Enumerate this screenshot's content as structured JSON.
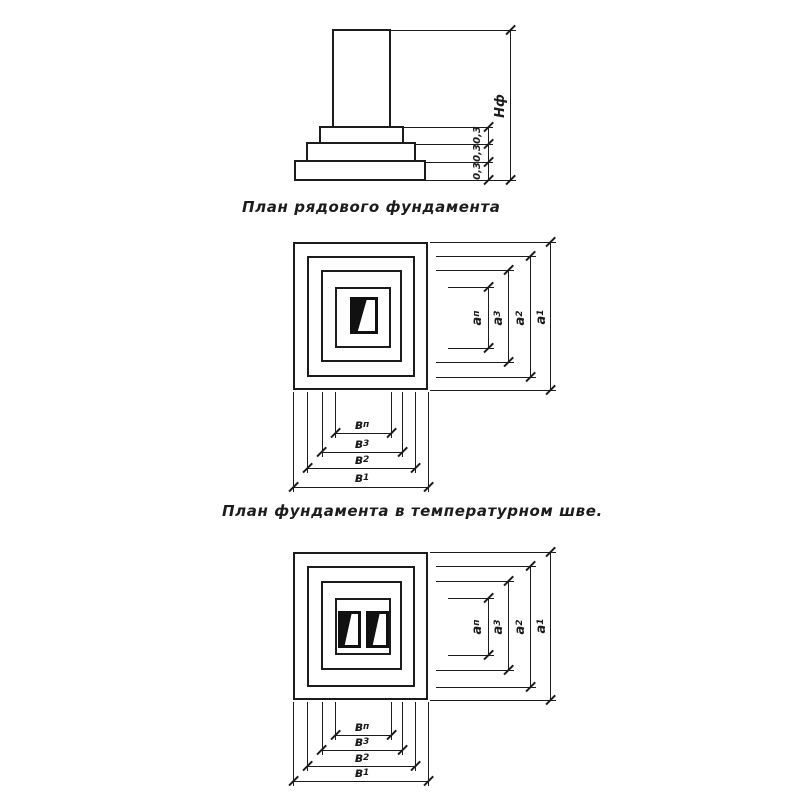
{
  "colors": {
    "ink": "#1c1c1c",
    "paper": "#ffffff"
  },
  "elevation": {
    "height_label": "Нф",
    "step_dims": [
      "0,3",
      "0,3",
      "0,3"
    ]
  },
  "captions": {
    "typical": "План рядового фундамента",
    "joint": "План фундамента в температурном шве."
  },
  "dim_labels": {
    "vertical": [
      {
        "base": "а",
        "sub": "п"
      },
      {
        "base": "а",
        "sub": "3"
      },
      {
        "base": "а",
        "sub": "2"
      },
      {
        "base": "а",
        "sub": "1"
      }
    ],
    "horizontal": [
      {
        "base": "в",
        "sub": "п"
      },
      {
        "base": "в",
        "sub": "3"
      },
      {
        "base": "в",
        "sub": "2"
      },
      {
        "base": "в",
        "sub": "1"
      }
    ]
  }
}
